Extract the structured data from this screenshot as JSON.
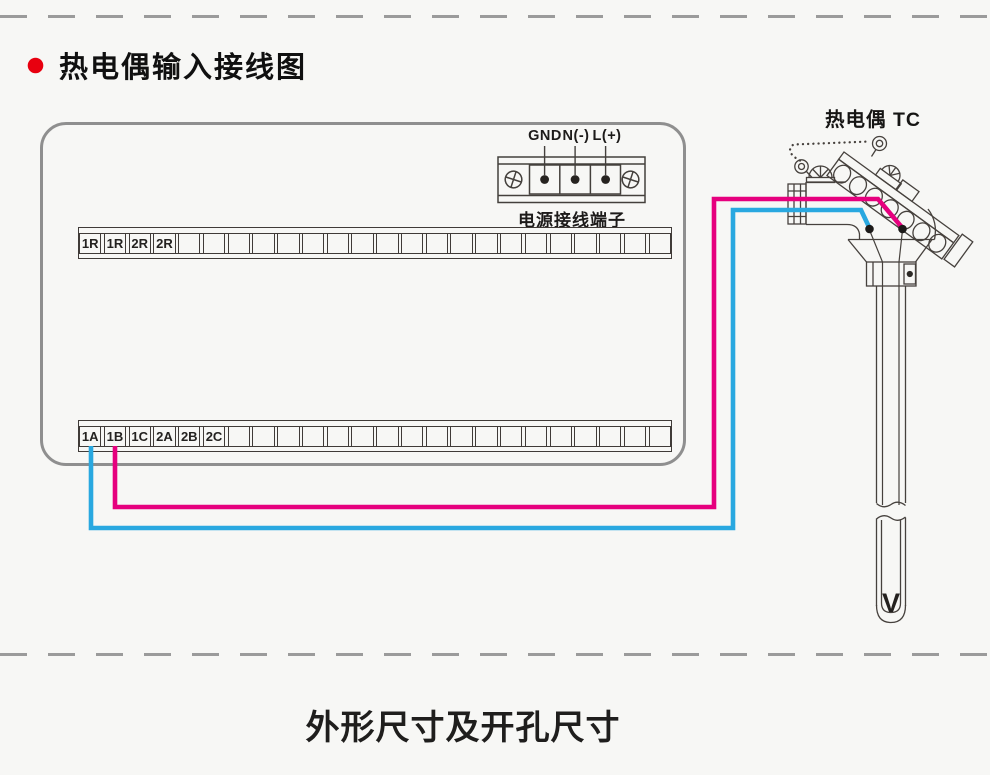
{
  "title": {
    "bullet_color": "#e8000f",
    "text": "热电偶输入接线图"
  },
  "wiring_panel": {
    "power_block": {
      "terminal_labels": [
        "GND",
        "N(-)",
        "L(+)"
      ],
      "caption": "电源接线端子"
    },
    "relay_strip": {
      "cells": [
        "1R",
        "1R",
        "2R",
        "2R",
        "",
        "",
        "",
        "",
        "",
        "",
        "",
        "",
        "",
        "",
        "",
        "",
        "",
        "",
        "",
        "",
        "",
        "",
        "",
        ""
      ]
    },
    "input_strip": {
      "cells": [
        "1A",
        "1B",
        "1C",
        "2A",
        "2B",
        "2C",
        "",
        "",
        "",
        "",
        "",
        "",
        "",
        "",
        "",
        "",
        "",
        "",
        "",
        "",
        "",
        "",
        "",
        ""
      ]
    }
  },
  "thermocouple": {
    "label": "热电偶 TC",
    "junction_mark": "V",
    "positive_wire_color": "#e6007e",
    "negative_wire_color": "#29a8e0"
  },
  "footer": {
    "caption": "外形尺寸及开孔尺寸"
  }
}
